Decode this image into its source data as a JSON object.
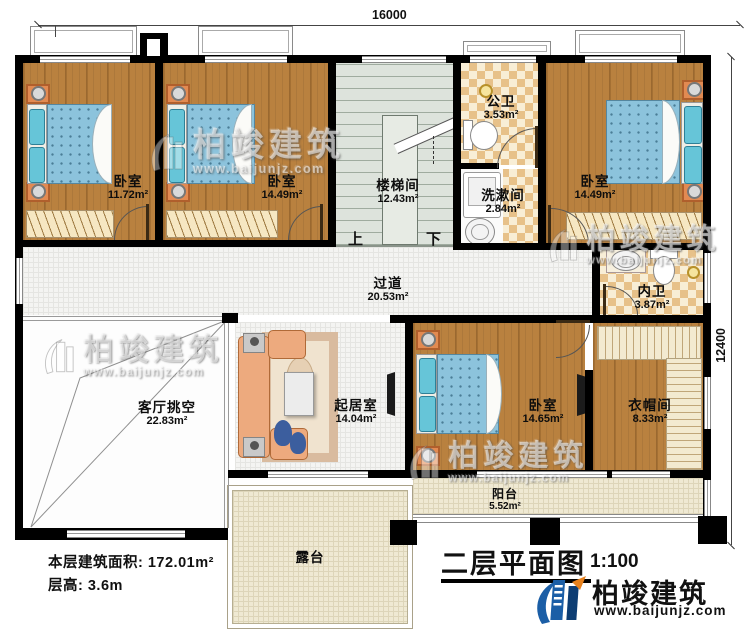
{
  "dimensions": {
    "top": "16000",
    "right": "12400"
  },
  "stairs": {
    "up": "上",
    "down": "下"
  },
  "rooms": {
    "bedroom1": {
      "name": "卧室",
      "area": "11.72m²"
    },
    "bedroom2": {
      "name": "卧室",
      "area": "14.49m²"
    },
    "stairwell": {
      "name": "楼梯间",
      "area": "12.43m²"
    },
    "public_bath": {
      "name": "公卫",
      "area": "3.53m²"
    },
    "washroom": {
      "name": "洗漱间",
      "area": "2.84m²"
    },
    "bedroom3": {
      "name": "卧室",
      "area": "14.49m²"
    },
    "inner_bath": {
      "name": "内卫",
      "area": "3.87m²"
    },
    "corridor": {
      "name": "过道",
      "area": "20.53m²"
    },
    "living_void": {
      "name": "客厅挑空",
      "area": "22.83m²"
    },
    "sitting_room": {
      "name": "起居室",
      "area": "14.04m²"
    },
    "bedroom4": {
      "name": "卧室",
      "area": "14.65m²"
    },
    "cloakroom": {
      "name": "衣帽间",
      "area": "8.33m²"
    },
    "balcony": {
      "name": "阳台",
      "area": "5.52m²"
    },
    "terrace": {
      "name": "露台"
    }
  },
  "stats": {
    "area_line": "本层建筑面积: 172.01m²",
    "height_line": "层高: 3.6m"
  },
  "title_block": {
    "title": "二层平面图",
    "scale": "1:100"
  },
  "brand": {
    "name": "柏竣建筑",
    "url": "www.baijunjz.com"
  },
  "watermark": {
    "name": "柏竣建筑",
    "url": "www.baijunjz.com"
  },
  "colors": {
    "wall": "#000000",
    "wood_floor": "#b9813f",
    "mattress": "#8cc3dc",
    "checker": "#e7c189",
    "terrace": "#efe9d3",
    "brand_blue": "#1b5ea6"
  }
}
